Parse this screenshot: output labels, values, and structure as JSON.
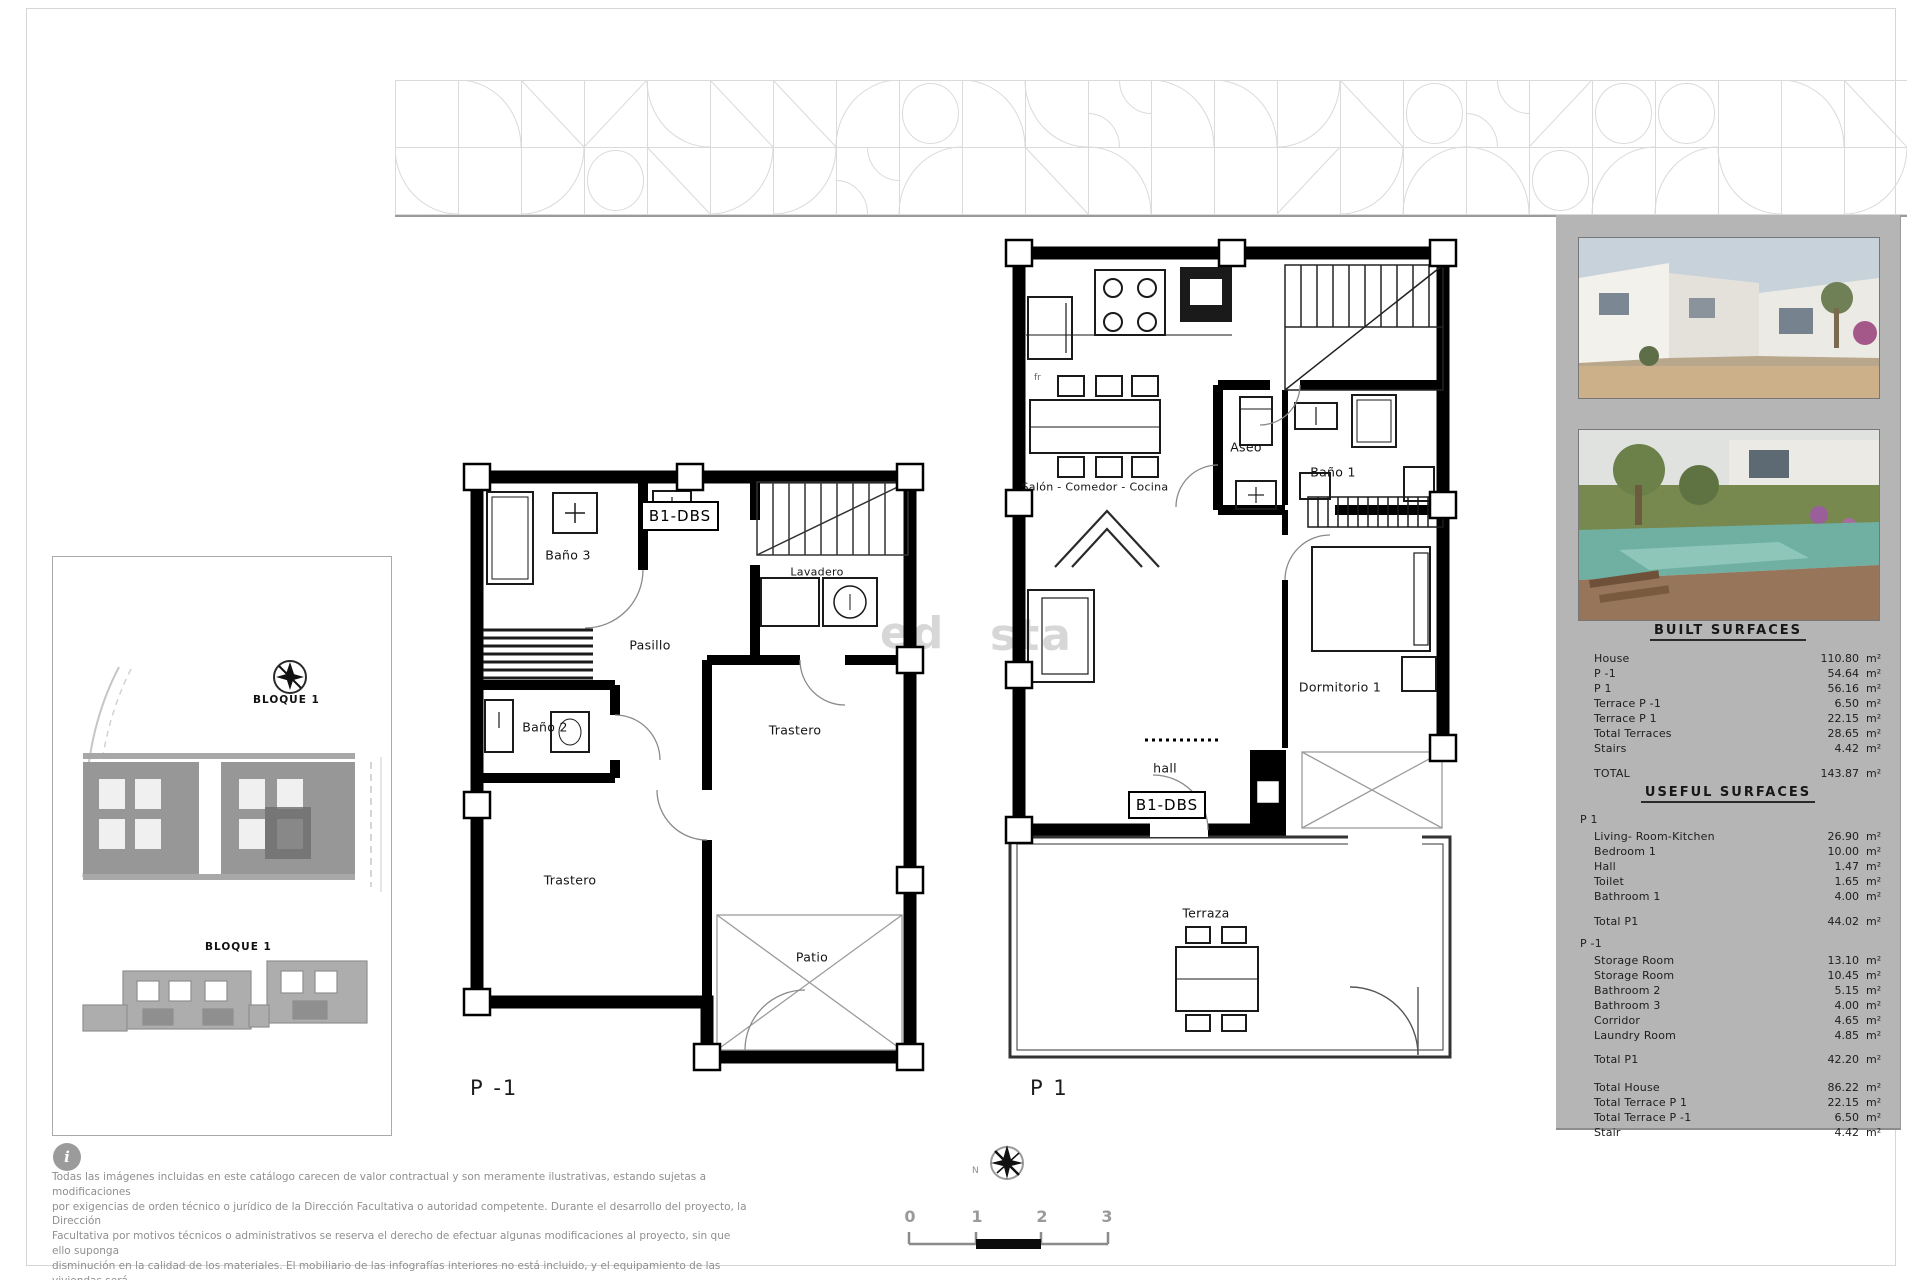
{
  "watermark": {
    "fragment_left": "ed",
    "fragment_right": "sta"
  },
  "left_panel": {
    "block_top_label": "BLOQUE 1",
    "block_bottom_label": "BLOQUE 1"
  },
  "plan_basement": {
    "title": "P -1",
    "unit_tag": "B1-DBS",
    "rooms": {
      "bano3": "Baño 3",
      "pasillo": "Pasillo",
      "lavadero": "Lavadero",
      "bano2": "Baño 2",
      "trastero_right": "Trastero",
      "trastero_left": "Trastero",
      "patio": "Patio"
    }
  },
  "plan_main": {
    "title": "P 1",
    "unit_tag": "B1-DBS",
    "fridge_tag": "fr",
    "rooms": {
      "salon": "Salón - Comedor - Cocina",
      "aseo": "Aseo",
      "bano1": "Baño 1",
      "dormitorio1": "Dormitorio 1",
      "hall": "hall",
      "terraza": "Terraza"
    }
  },
  "sidebar": {
    "built_title": "BUILT SURFACES",
    "built_rows": [
      {
        "label": "House",
        "value": "110.80",
        "unit": "m²"
      },
      {
        "label": "P -1",
        "value": "54.64",
        "unit": "m²"
      },
      {
        "label": "P 1",
        "value": "56.16",
        "unit": "m²"
      },
      {
        "label": "Terrace  P -1",
        "value": "6.50",
        "unit": "m²"
      },
      {
        "label": "Terrace  P 1",
        "value": "22.15",
        "unit": "m²"
      },
      {
        "label": "Total Terraces",
        "value": "28.65",
        "unit": "m²"
      },
      {
        "label": "Stairs",
        "value": "4.42",
        "unit": "m²"
      }
    ],
    "built_total": {
      "label": "TOTAL",
      "value": "143.87",
      "unit": "m²"
    },
    "useful_title": "USEFUL SURFACES",
    "useful_p1_heading": "P 1",
    "useful_p1_rows": [
      {
        "label": "Living- Room-Kitchen",
        "value": "26.90",
        "unit": "m²"
      },
      {
        "label": "Bedroom 1",
        "value": "10.00",
        "unit": "m²"
      },
      {
        "label": "Hall",
        "value": "1.47",
        "unit": "m²"
      },
      {
        "label": "Toilet",
        "value": "1.65",
        "unit": "m²"
      },
      {
        "label": "Bathroom 1",
        "value": "4.00",
        "unit": "m²"
      }
    ],
    "useful_p1_total": {
      "label": "Total  P1",
      "value": "44.02",
      "unit": "m²"
    },
    "useful_pm1_heading": "P -1",
    "useful_pm1_rows": [
      {
        "label": "Storage Room",
        "value": "13.10",
        "unit": "m²"
      },
      {
        "label": "Storage Room",
        "value": "10.45",
        "unit": "m²"
      },
      {
        "label": "Bathroom 2",
        "value": "5.15",
        "unit": "m²"
      },
      {
        "label": "Bathroom 3",
        "value": "4.00",
        "unit": "m²"
      },
      {
        "label": "Corridor",
        "value": "4.65",
        "unit": "m²"
      },
      {
        "label": "Laundry Room",
        "value": "4.85",
        "unit": "m²"
      }
    ],
    "useful_pm1_total": {
      "label": "Total  P1",
      "value": "42.20",
      "unit": "m²"
    },
    "summary_rows": [
      {
        "label": "Total  House",
        "value": "86.22",
        "unit": "m²"
      },
      {
        "label": "Total Terrace  P 1",
        "value": "22.15",
        "unit": "m²"
      },
      {
        "label": "Total Terrace  P -1",
        "value": "6.50",
        "unit": "m²"
      },
      {
        "label": "Stair",
        "value": "4.42",
        "unit": "m²"
      }
    ]
  },
  "footer": {
    "info_glyph": "i",
    "disclaimer_lines": [
      "Todas las imágenes incluidas en este catálogo carecen de valor contractual y son meramente ilustrativas, estando sujetas a modificaciones",
      "por exigencias de orden técnico o jurídico de la Dirección Facultativa o autoridad competente. Durante el desarrollo del proyecto, la Dirección",
      "Facultativa por motivos técnicos o administrativos se reserva el derecho de efectuar algunas modificaciones al proyecto, sin que ello suponga",
      "disminución en la calidad de los materiales. El mobiliario de las infografías interiores no está incluido, y el equipamiento de las viviendas será",
      "el indicado en la correspondiente memoria de calidades."
    ],
    "north_label": "N",
    "scale_labels": [
      "0",
      "1",
      "2",
      "3"
    ]
  }
}
